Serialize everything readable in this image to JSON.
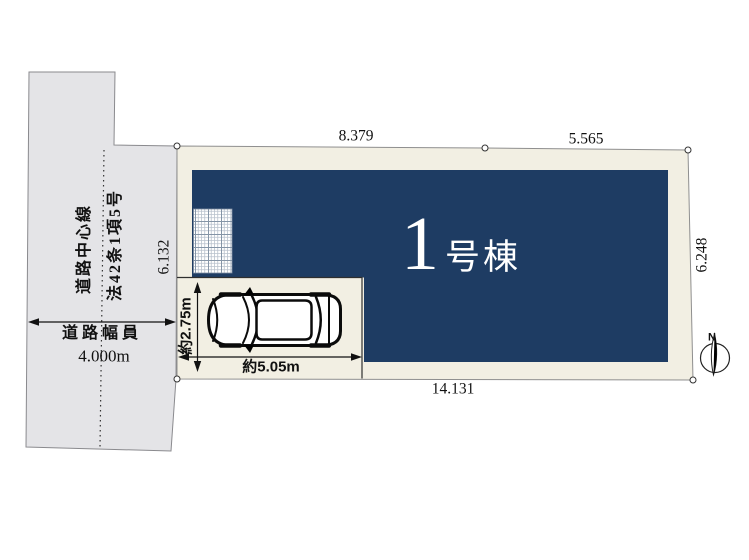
{
  "colors": {
    "building_fill": "#1e3c63",
    "plot_fill": "#f2efe3",
    "road_fill": "#e4e4e7",
    "building_text": "#ffffff",
    "line": "#111111"
  },
  "road": {
    "centerline_label": "道路中心線",
    "law_label": "法42条1項5号",
    "width_label": "道路幅員",
    "width_value": "4.000m"
  },
  "plot_dimensions": {
    "top_left": "8.379",
    "top_right": "5.565",
    "left": "6.132",
    "right": "6.248",
    "bottom": "14.131"
  },
  "building": {
    "number": "1",
    "suffix": "号棟"
  },
  "parking": {
    "depth": "約2.75m",
    "width": "約5.05m"
  },
  "compass": {
    "north": "N"
  }
}
